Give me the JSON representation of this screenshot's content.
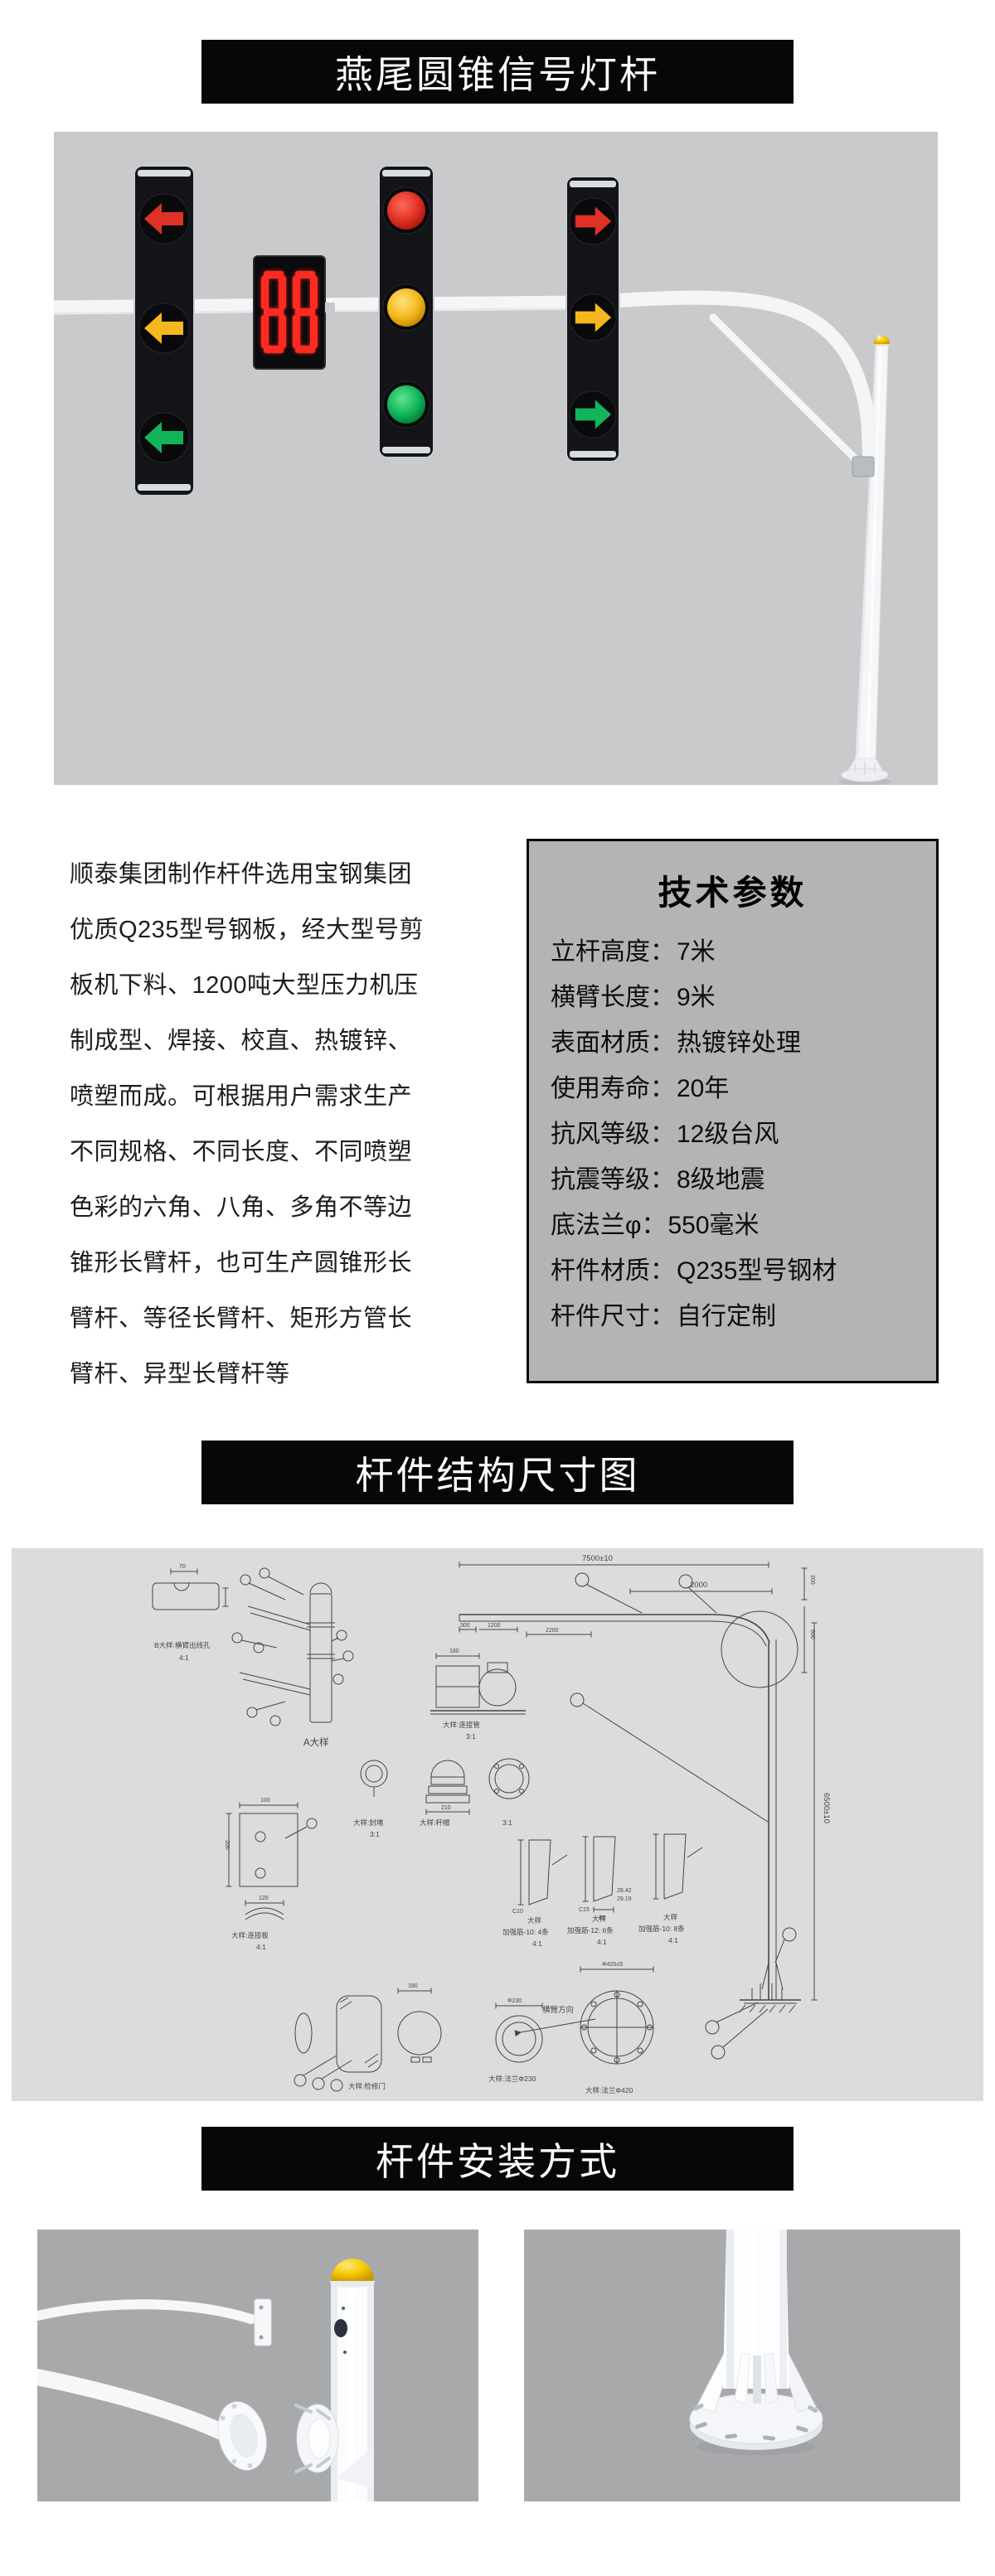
{
  "banners": {
    "product_title": "燕尾圆锥信号灯杆",
    "structure_title": "杆件结构尺寸图",
    "install_title": "杆件安装方式"
  },
  "intro": {
    "lines": [
      "顺泰集团制作杆件选用宝钢集团",
      "优质Q235型号钢板，经大型号剪",
      "板机下料、1200吨大型压力机压",
      "制成型、焊接、校直、热镀锌、",
      "喷塑而成。可根据用户需求生产",
      "不同规格、不同长度、不同喷塑",
      "色彩的六角、八角、多角不等边",
      "锥形长臂杆，也可生产圆锥形长",
      "臂杆、等径长臂杆、矩形方管长",
      "臂杆、异型长臂杆等"
    ]
  },
  "specs": {
    "title": "技术参数",
    "rows": [
      {
        "label": "立杆高度：",
        "value": "7米"
      },
      {
        "label": "横臂长度：",
        "value": "9米"
      },
      {
        "label": "表面材质：",
        "value": "热镀锌处理"
      },
      {
        "label": "使用寿命：",
        "value": "20年"
      },
      {
        "label": "抗风等级：",
        "value": "12级台风"
      },
      {
        "label": "抗震等级：",
        "value": "8级地震"
      },
      {
        "label": "底法兰φ：",
        "value": "550毫米"
      },
      {
        "label": "杆件材质：",
        "value": "Q235型号钢材"
      },
      {
        "label": "杆件尺寸：",
        "value": "自行定制"
      }
    ]
  },
  "countdown": {
    "value": "88"
  },
  "drawing": {
    "dims": {
      "d7500": "7500±10",
      "d2000": "2000",
      "d2200": "2200",
      "d1200": "1200",
      "d300": "300",
      "d200": "200",
      "d600": "600",
      "d6500": "6500±10",
      "d70": "70",
      "d100": "100",
      "d120": "120",
      "d180": "180",
      "d210": "210",
      "d230": "Φ230",
      "d420": "Φ420±5",
      "d80": "80",
      "d2842": "28.42",
      "d2919": "29.19",
      "c10": "C10",
      "c15": "C15"
    },
    "labels": {
      "a_detail": "A大样",
      "b_detail": "B大样:横臂出线孔",
      "detail": "大样",
      "scale41": "4:1",
      "scale31": "3:1",
      "conn_tube": "大样:连接管",
      "conn_plate": "大样:连接板",
      "cap": "大样:杆帽",
      "plug": "大样:封堵",
      "door": "大样:检修门",
      "flange420": "大样:法兰Φ420",
      "flange230": "大样:法兰Φ230",
      "arm_dir": "横臂方向",
      "rib1": "加强筋-10: 4条",
      "rib2": "加强筋-12: 6条",
      "rib3": "加强筋-10: 8条"
    }
  },
  "colors": {
    "banner-bg": "#070707",
    "banner-text": "#ffffff",
    "photo-bg": "#c9cacb",
    "photo-bg-dark": "#a8a9ab",
    "draw-bg": "#dbdcde",
    "box-bg": "#b3b4b6",
    "box-border": "#0a0a0a",
    "sig-red": "#e03127",
    "sig-amber": "#f4b81e",
    "sig-green": "#12b45a",
    "countdown-red": "#ff2b22",
    "cap-yellow": "#f6c800",
    "steel-white": "#f4f5f7",
    "line": "#454545"
  }
}
